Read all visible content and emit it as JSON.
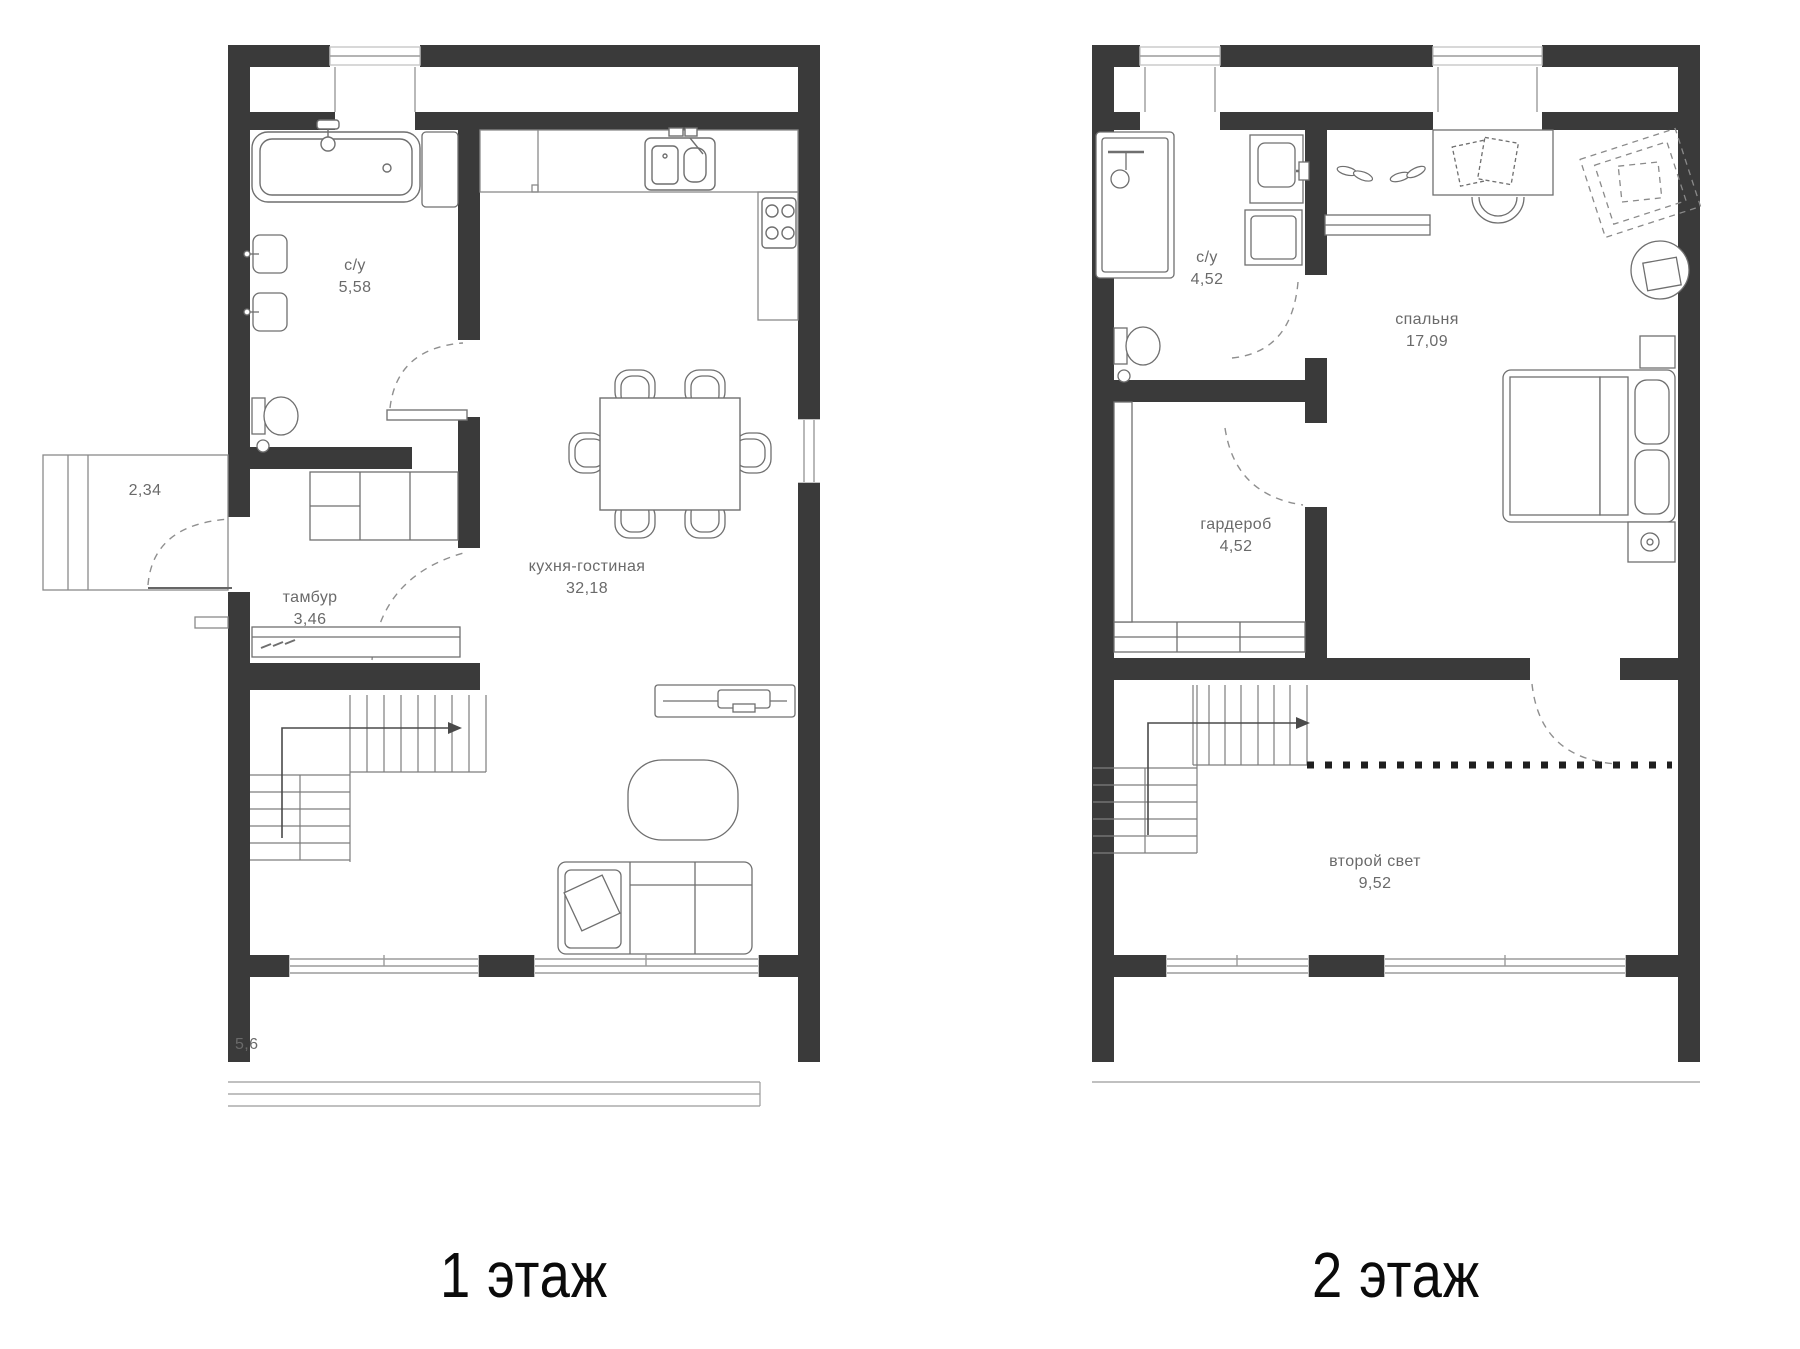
{
  "floor1": {
    "caption": "1 этаж",
    "labels": {
      "bathroom": {
        "name": "с/у",
        "area": "5,58"
      },
      "vestibule": {
        "name": "тамбур",
        "area": "3,46"
      },
      "kitchen_living": {
        "name": "кухня-гостиная",
        "area": "32,18"
      },
      "porch_area": "2,34",
      "terrace_area": "5,6"
    }
  },
  "floor2": {
    "caption": "2 этаж",
    "labels": {
      "bathroom": {
        "name": "с/у",
        "area": "4,52"
      },
      "wardrobe": {
        "name": "гардероб",
        "area": "4,52"
      },
      "bedroom": {
        "name": "спальня",
        "area": "17,09"
      },
      "second_light": {
        "name": "второй свет",
        "area": "9,52"
      }
    }
  },
  "colors": {
    "wall": "#3a3a3a",
    "furniture": "#6f6f6f",
    "window": "#9b9b9b",
    "label": "#6a6a6a"
  }
}
